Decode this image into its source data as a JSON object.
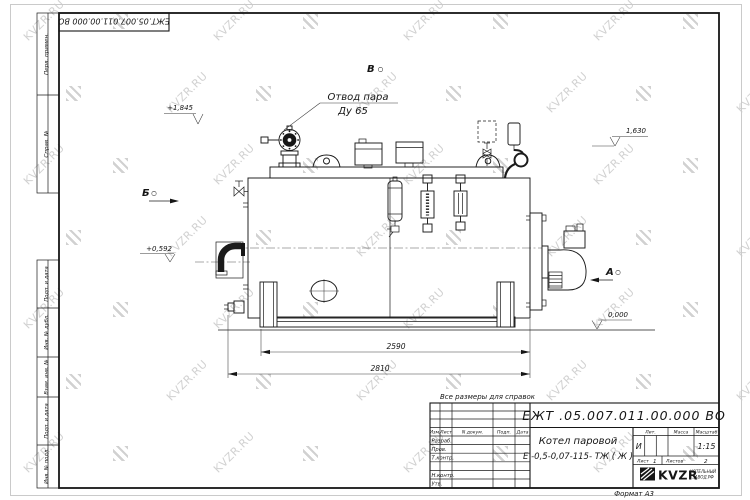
{
  "watermark": {
    "text": "KVZR.RU"
  },
  "frame": {
    "top_stamp": "ЕЖТ.05.007.011.00.000  ВО",
    "margin_labels": {
      "perv_primen": "Перв. примен.",
      "sprav_no": "Справ. №",
      "podp_data_1": "Подп. и дата",
      "inv_dubl": "Инв. № дубл.",
      "vzam_inv": "Взам. инв. №",
      "podp_data_2": "Подп. и дата",
      "inv_podl": "Инв. № подл."
    }
  },
  "drawing": {
    "note": "Все размеры для справок",
    "callout": {
      "line1": "Отвод пара",
      "line2": "Ду 65"
    },
    "view_labels": {
      "a": "А",
      "b": "Б",
      "v": "В"
    },
    "elevations": {
      "valve_top": "+1,845",
      "right": "1,630",
      "left": "+0,592",
      "ground": "0,000"
    },
    "dimensions": {
      "base_length": "2590",
      "overall_length": "2810"
    }
  },
  "title_block": {
    "designation": "ЕЖТ .05.007.011.00.000  ВО",
    "product_name": "Котел паровой",
    "product_model": "Е -0,5-0,07-115- ТЖ ( Ж )",
    "table_headers": {
      "izm": "Изм.",
      "list": "Лист",
      "n_dokum": "N докум.",
      "podp": "Подп.",
      "data": "Дата"
    },
    "signature_rows": {
      "razrab": "Разраб.",
      "prov": "Пров.",
      "t_kontr": "Т.контр.",
      "n_kontr": "Н.контр.",
      "utv": "Утв."
    },
    "right_headers": {
      "lit": "Лит.",
      "massa": "Масса",
      "masshtab": "Масштаб"
    },
    "lit_value": "И",
    "scale_value": "1:15",
    "sheet_info": {
      "list_label": "Лист",
      "list_value": "1",
      "listov_label": "Листов",
      "listov_value": "2"
    },
    "logo": {
      "name": "KVZR",
      "sub_line1": "КОТЕЛЬНЫЙ",
      "sub_line2": "ЗАВОД.РФ"
    },
    "format_label": "Формат А3"
  }
}
